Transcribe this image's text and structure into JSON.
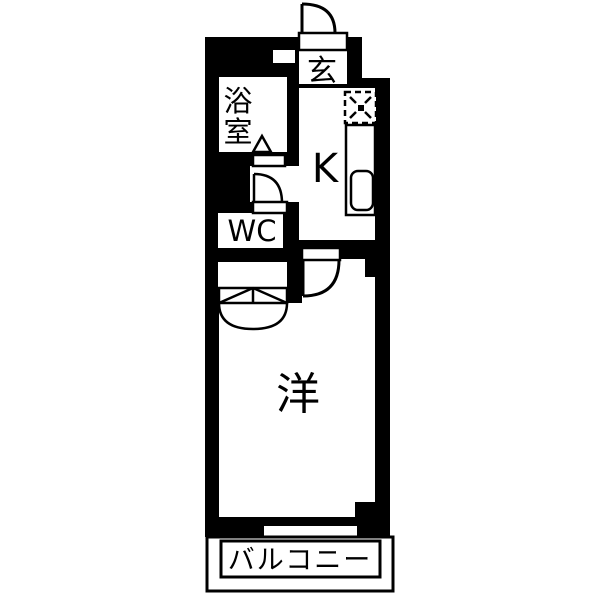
{
  "plan": {
    "type": "japanese-apartment-floorplan",
    "rooms": {
      "entrance": {
        "label": "玄"
      },
      "bath": {
        "label": "浴室",
        "chars": [
          "浴",
          "室"
        ]
      },
      "kitchen": {
        "label": "K"
      },
      "wc": {
        "label": "WC"
      },
      "western_room": {
        "label": "洋"
      },
      "balcony": {
        "label": "バルコニー"
      }
    },
    "colors": {
      "wall": "#000000",
      "floor": "#ffffff"
    }
  }
}
